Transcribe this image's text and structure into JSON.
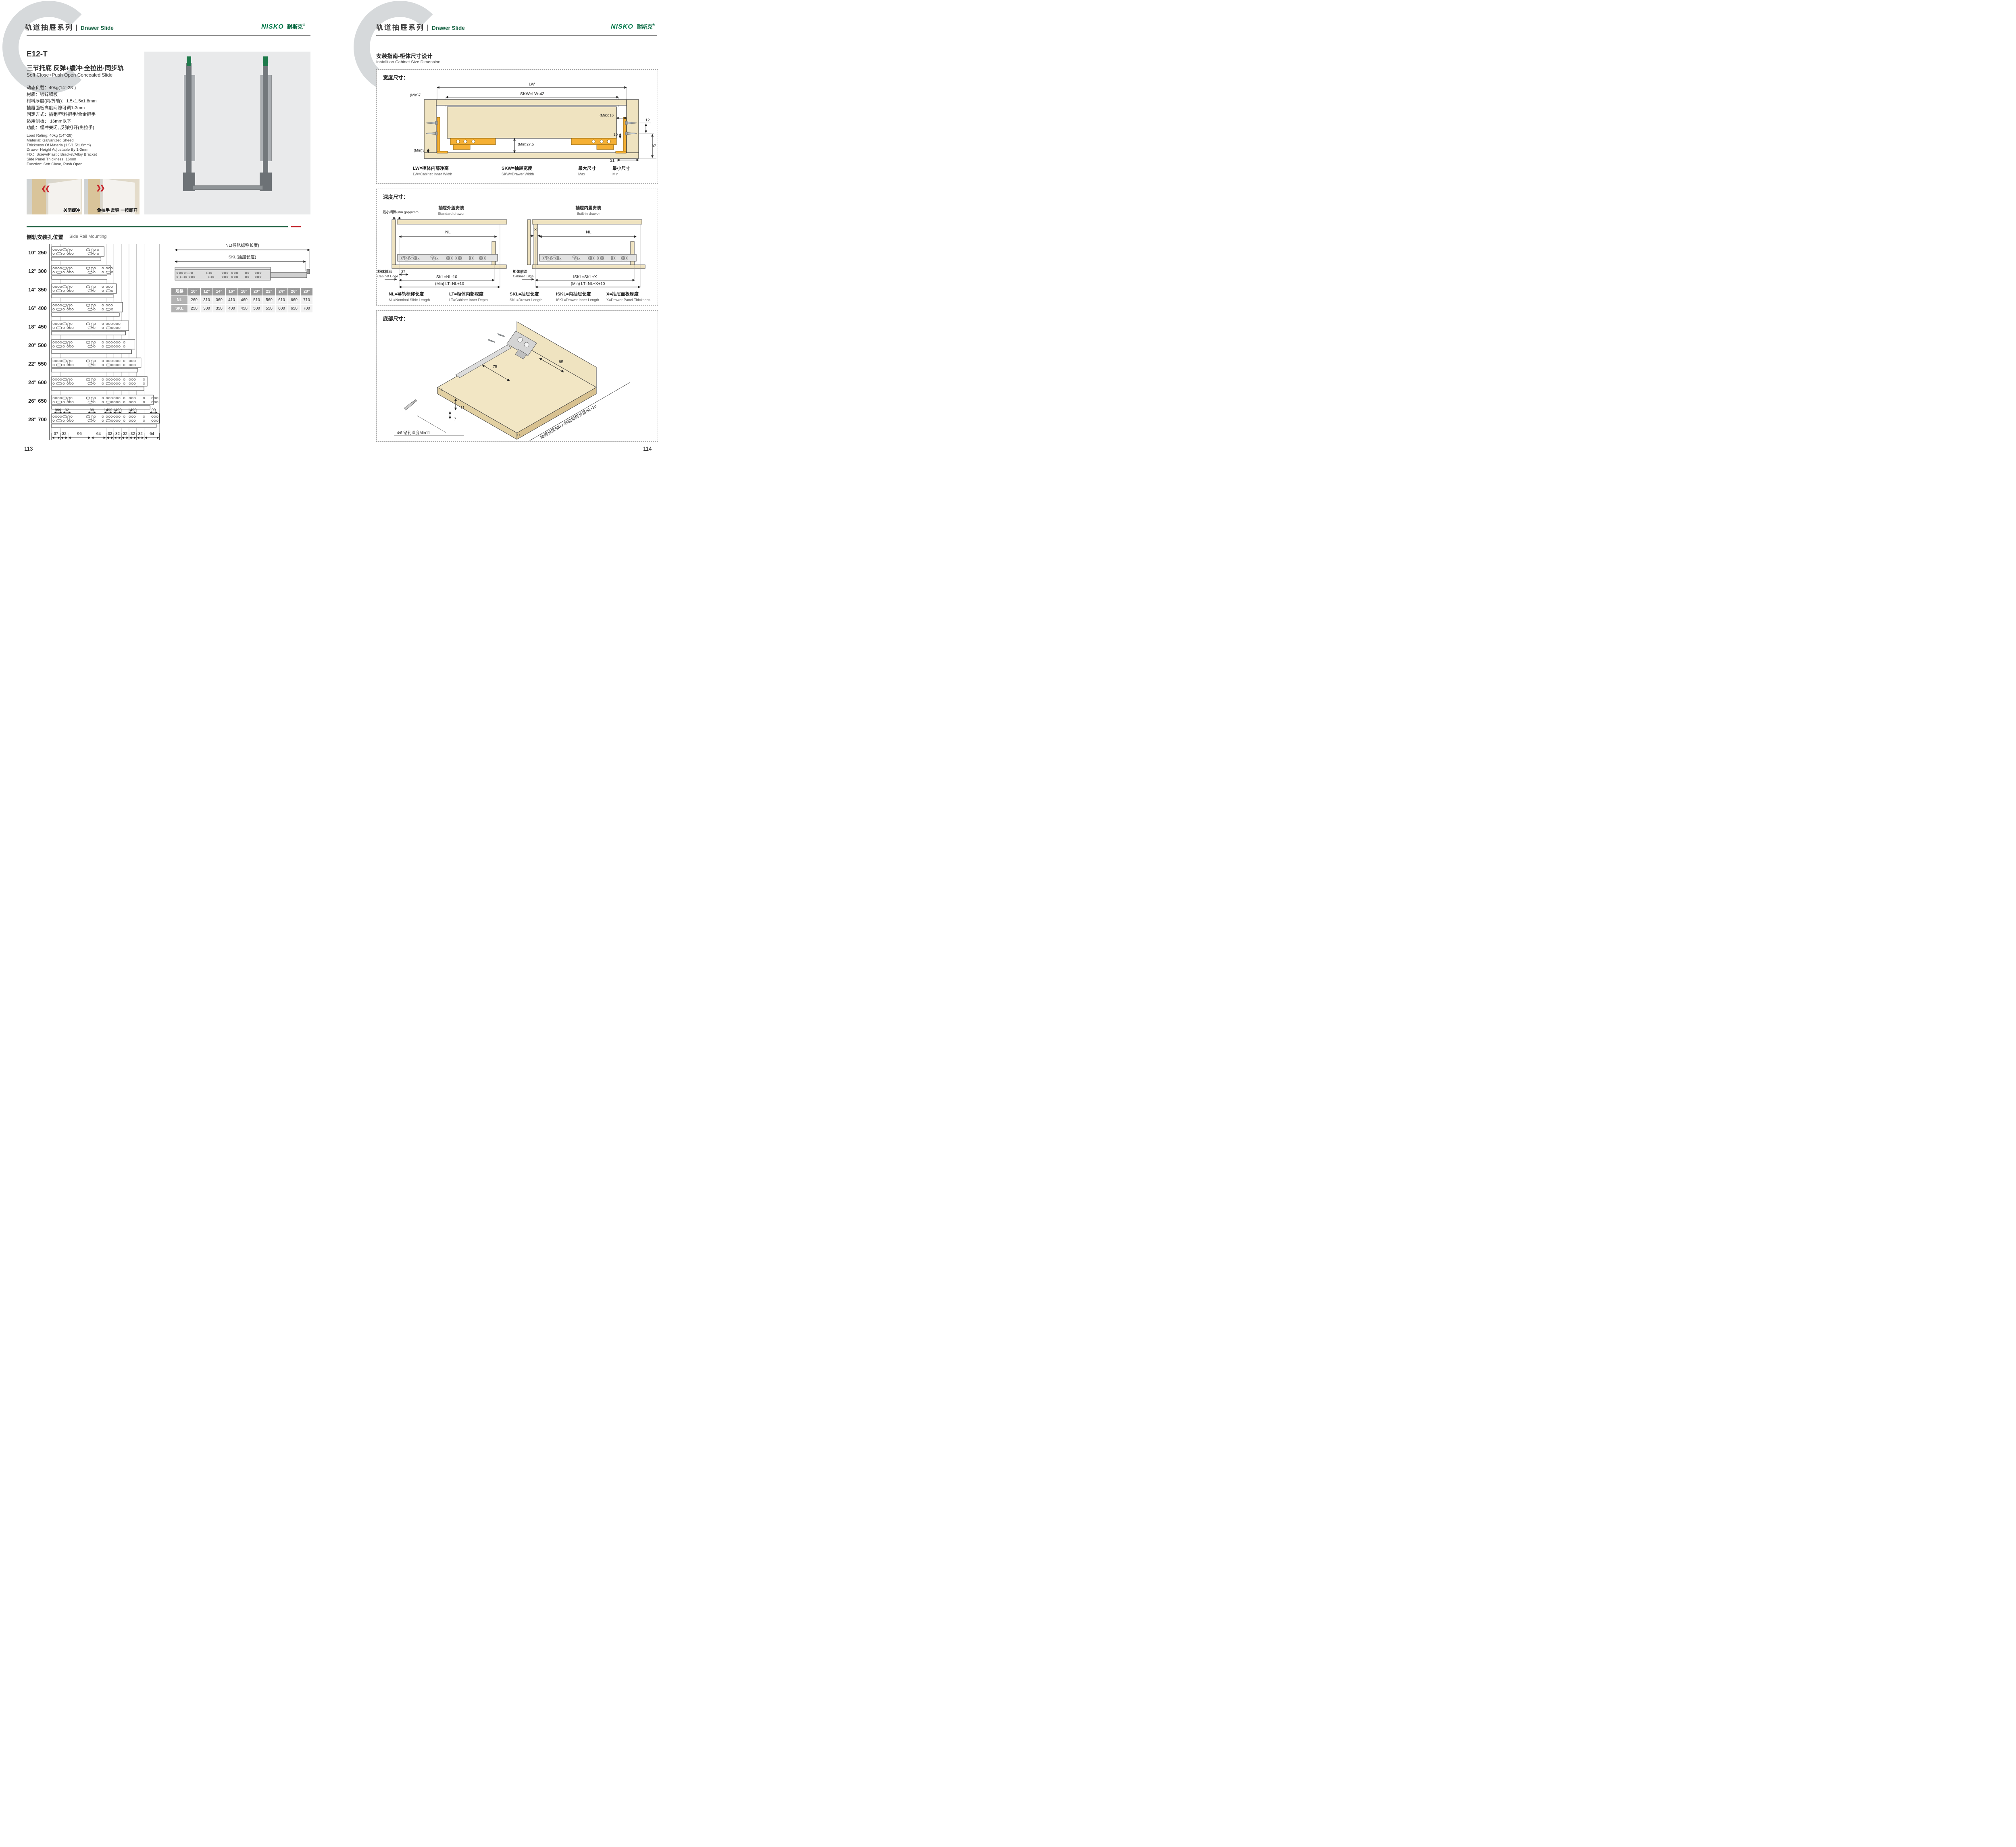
{
  "logo": {
    "latin": "NISKO",
    "cn": "耐斯克",
    "reg": "®"
  },
  "header": {
    "series_cn": "轨道抽屉系列",
    "series_en": "Drawer Slide"
  },
  "colors": {
    "brand_green": "#1b5e3e",
    "accent_red": "#bf1a22",
    "wood_tan": "#efe3c0",
    "hardware_orange": "#f5b034"
  },
  "left_page": {
    "page_number": "113",
    "model": "E12-T",
    "title_cn": "三节托底 反弹+缓冲·全拉出·同步轨",
    "title_en": "Soft Close+Push Open Concealed Slide",
    "specs_cn": [
      "动态负载：40kg(14\"-28\")",
      "材质：镀锌钢板",
      "材料厚度(内/外轨)：1.5x1.5x1.8mm",
      "抽屉面板高度间隙可调1-3mm",
      "固定方式：插销/塑料把手/合金把手",
      "适用侧板： 16mm以下",
      "功能：缓冲关闭, 反弹打开(免拉手)"
    ],
    "specs_en": [
      "Load Rating: 40kg (14\"-28)",
      "Material: Galvanized Sheed",
      "Thickness Of Materia (1.5/1.5/1.8mm)",
      "Drawer Height Adjustable By 1-3mm",
      "FIX：Screw/Plastic Bracket/Alloy Bracket",
      "Side Panel Thickness: 16mm",
      "Function: Soft Close, Push Open"
    ],
    "photo_captions": [
      "关闭缓冲",
      "免拉手 反弹 一按即开"
    ],
    "section": {
      "title_cn": "侧轨安装孔位置",
      "title_en": "Side Rail Mounting",
      "rails": [
        {
          "size": "10\"",
          "length": "250"
        },
        {
          "size": "12\"",
          "length": "300"
        },
        {
          "size": "14\"",
          "length": "350"
        },
        {
          "size": "16\"",
          "length": "400"
        },
        {
          "size": "18\"",
          "length": "450"
        },
        {
          "size": "20\"",
          "length": "500"
        },
        {
          "size": "22\"",
          "length": "550"
        },
        {
          "size": "24\"",
          "length": "600"
        },
        {
          "size": "26\"",
          "length": "650"
        },
        {
          "size": "28\"",
          "length": "700"
        }
      ],
      "top_dims": [
        "999",
        "32",
        "99",
        "1499",
        "1499",
        "1499",
        "99"
      ],
      "bottom_dims": [
        "37",
        "32",
        "96",
        "64",
        "32",
        "32",
        "32",
        "32",
        "32",
        "64"
      ],
      "nl_label": "NL(导轨标称长度)",
      "skl_label": "SKL(抽屉长度)",
      "table": {
        "header": [
          "规格",
          "10\"",
          "12\"",
          "14\"",
          "16\"",
          "18\"",
          "20\"",
          "22\"",
          "24\"",
          "26\"",
          "28\""
        ],
        "rows": [
          {
            "label": "NL",
            "values": [
              "260",
              "310",
              "360",
              "410",
              "460",
              "510",
              "560",
              "610",
              "660",
              "710"
            ]
          },
          {
            "label": "SKL",
            "values": [
              "250",
              "300",
              "350",
              "400",
              "450",
              "500",
              "550",
              "600",
              "650",
              "700"
            ]
          }
        ]
      }
    }
  },
  "right_page": {
    "page_number": "114",
    "guide_title_cn": "安装指南-柜体尺寸设计",
    "guide_title_en": "Installtion Cabinet Size Dimension",
    "width_box": {
      "title": "宽度尺寸：",
      "dims": {
        "lw": "LW",
        "skw": "SKW=LW-42",
        "min7": "(Min)7",
        "max16": "(Max)16",
        "d10": "10",
        "min275": "(Min)27.5",
        "min3": "(Min)3",
        "d12": "12",
        "d37": "37",
        "d21": "21"
      },
      "legend": [
        {
          "cn": "LW=柜体内部净高",
          "en": "LW=Cabinet Inner Width"
        },
        {
          "cn": "SKW=抽屉宽度",
          "en": "SKW=Drawer  Width"
        },
        {
          "cn": "最大尺寸",
          "en": "Max"
        },
        {
          "cn": "最小尺寸",
          "en": "Min"
        }
      ]
    },
    "depth_box": {
      "title": "深度尺寸：",
      "min_gap": "最小间隙(Min gap)4mm",
      "standard": {
        "cn": "抽屉外盖安装",
        "en": "Standard drawer",
        "nl": "NL",
        "d37": "37",
        "skl": "SKL=NL-10",
        "lt": "(Min) LT=NL+10",
        "edge_cn": "柜体前沿",
        "edge_en": "Cabinet Edge"
      },
      "builtin": {
        "cn": "抽屉内置安装",
        "en": "Built-in drawer",
        "x": "X",
        "nl": "NL",
        "iskl": "ISKL=SKL+X",
        "lt": "(Min) LT=NL+X+10",
        "edge_cn": "柜体前沿",
        "edge_en": "Cabinet Edge"
      },
      "legend": [
        {
          "cn": "NL=导轨标称长度",
          "en": "NL=Nominal Slide Length"
        },
        {
          "cn": "LT=柜体内部深度",
          "en": "LT=Cabinet Inner Depth"
        },
        {
          "cn": "SKL=抽屉长度",
          "en": "SKL=Drawer Length"
        },
        {
          "cn": "ISKL=内抽屉长度",
          "en": "ISKL=Drawer Inner Length"
        },
        {
          "cn": "X=抽屉面板厚度",
          "en": "X=Drawer Panel Thickness"
        }
      ]
    },
    "bottom_box": {
      "title": "底部尺寸：",
      "dims": {
        "d75": "75",
        "d85": "85",
        "d11": "11",
        "d7": "7",
        "drill": "Φ6 钻孔深度Min11",
        "skl_note": "抽屉长度SKL=导轨标称长度NL-10"
      }
    }
  }
}
